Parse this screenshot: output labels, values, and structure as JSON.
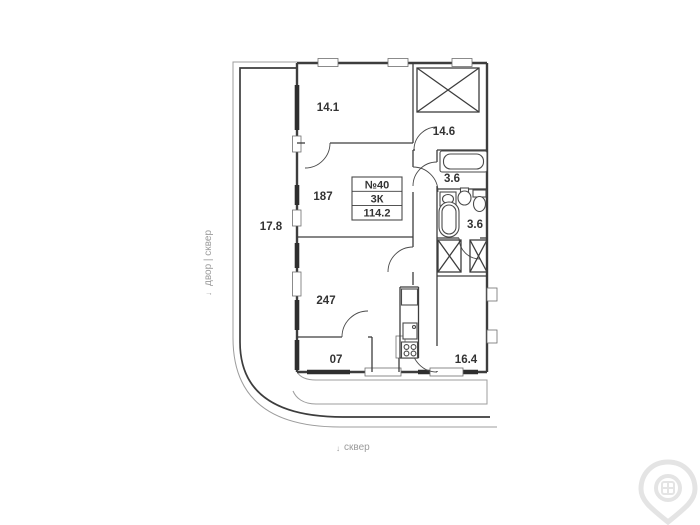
{
  "plan": {
    "unit_box": {
      "number": "№40",
      "type": "3К",
      "area": "114.2"
    },
    "rooms": [
      {
        "id": "bedroom-1",
        "label": "14.1"
      },
      {
        "id": "bedroom-2",
        "label": "14.6"
      },
      {
        "id": "balcony",
        "label": "17.8"
      },
      {
        "id": "bedroom-3",
        "label": "187"
      },
      {
        "id": "bathroom-1",
        "label": "3.6"
      },
      {
        "id": "bathroom-2",
        "label": "3.6"
      },
      {
        "id": "living-room",
        "label": "247"
      },
      {
        "id": "loggia",
        "label": "07"
      },
      {
        "id": "kitchen",
        "label": "16.4"
      }
    ],
    "surroundings": {
      "left_label": "двор | сквер",
      "bottom_label": "сквер",
      "arrow": "↓"
    }
  },
  "colors": {
    "background": "#ffffff",
    "wall": "#3d3d3d",
    "label_text": "#333333",
    "env_text": "#9b9b9b",
    "watermark": "#e4e4e4"
  }
}
